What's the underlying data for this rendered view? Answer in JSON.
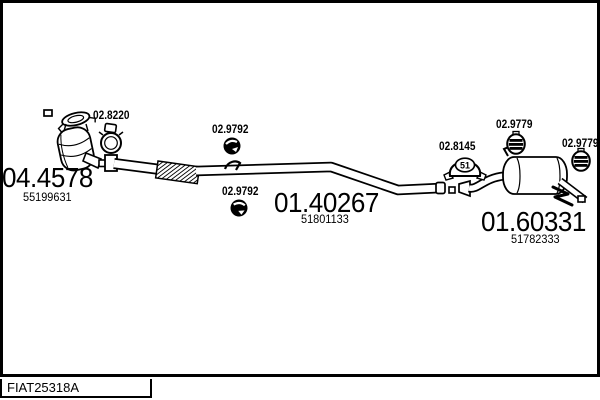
{
  "sections": [
    {
      "name": "catalytic-converter",
      "part_code": "04.4578",
      "oe_number": "55199631"
    },
    {
      "name": "centre-pipe",
      "part_code": "01.40267",
      "oe_number": "51801133"
    },
    {
      "name": "rear-silencer",
      "part_code": "01.60331",
      "oe_number": "51782333"
    }
  ],
  "fittings": [
    {
      "name": "pipe-clamp-front",
      "part_code": "02.8220"
    },
    {
      "name": "rubber-mount-upper",
      "part_code": "02.9792"
    },
    {
      "name": "rubber-mount-lower",
      "part_code": "02.9792"
    },
    {
      "name": "pipe-clamp-rear",
      "part_code": "02.8145",
      "size_label": "51"
    },
    {
      "name": "rubber-hanger-left",
      "part_code": "02.9779"
    },
    {
      "name": "rubber-hanger-right",
      "part_code": "02.9779"
    }
  ],
  "drawing_code": "FIAT25318A",
  "colors": {
    "line": "#000000",
    "background": "#ffffff"
  }
}
